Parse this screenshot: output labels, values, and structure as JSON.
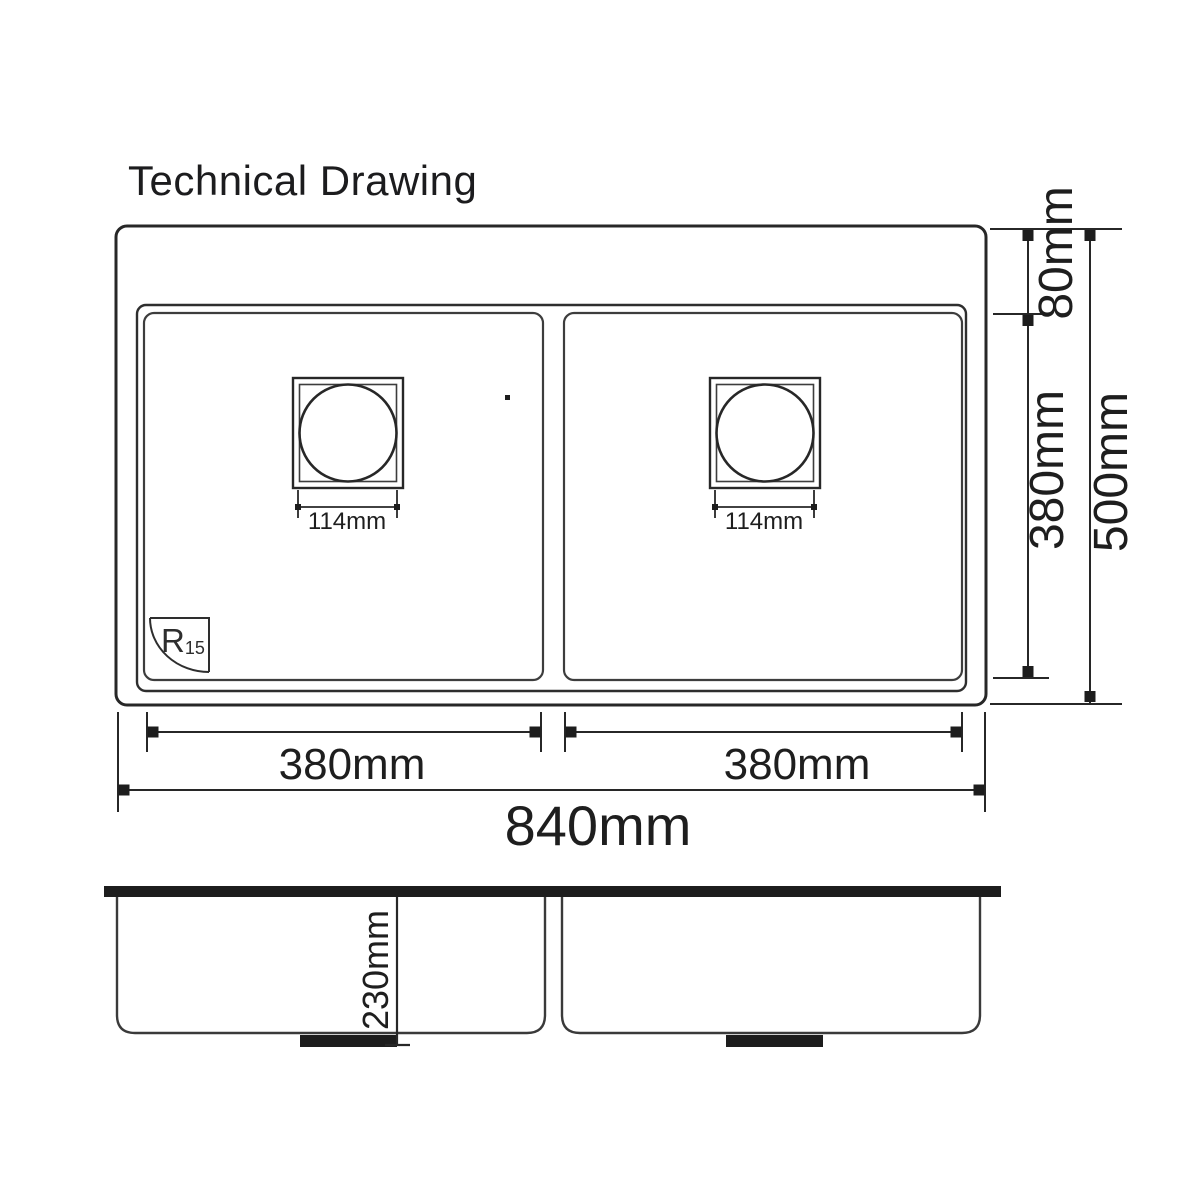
{
  "title": "Technical Drawing",
  "top_view": {
    "rim_height_label": "80mm",
    "bowl_depth_label": "380mm",
    "overall_depth_label": "500mm",
    "left_bowl_width_label": "380mm",
    "right_bowl_width_label": "380mm",
    "overall_width_label": "840mm",
    "left_drain_label": "114mm",
    "right_drain_label": "114mm",
    "corner_radius": {
      "prefix": "R",
      "sub": "15"
    }
  },
  "side_view": {
    "depth_label": "230mm"
  },
  "colors": {
    "background": "#ffffff",
    "line": "#2b2b2b",
    "bowl_line": "#3d3d3d",
    "text": "#1e1e1e",
    "solid_fill": "#1d1d1d"
  }
}
